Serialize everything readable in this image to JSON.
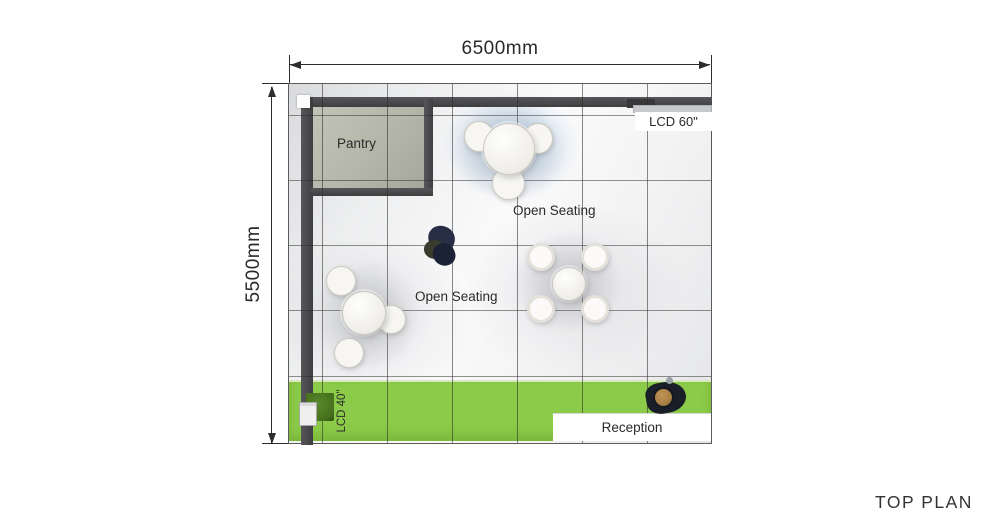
{
  "plan": {
    "title": "TOP PLAN",
    "dim_width": "6500mm",
    "dim_height": "5500mm",
    "pantry_label": "Pantry",
    "open_seating_top": "Open Seating",
    "open_seating_left": "Open Seating",
    "lcd60_label": "LCD 60\"",
    "lcd40_label": "LCD 40\"",
    "reception_label": "Reception"
  },
  "colors": {
    "wall": "#4a4a4c",
    "pantry_floor": "#b5b6aa",
    "carpet_green": "#8ccb49",
    "dim_line": "#2d2d2d",
    "text_dark": "#2a2a2a",
    "table_fill": "#f7f6f2",
    "table_edge": "#ccc9c0",
    "person_navy": "#272e46",
    "person_black": "#1a1e28",
    "person_head_tan": "#a87f45",
    "planter_green": "#46701d",
    "lcd_gray": "#c7c9cb"
  }
}
